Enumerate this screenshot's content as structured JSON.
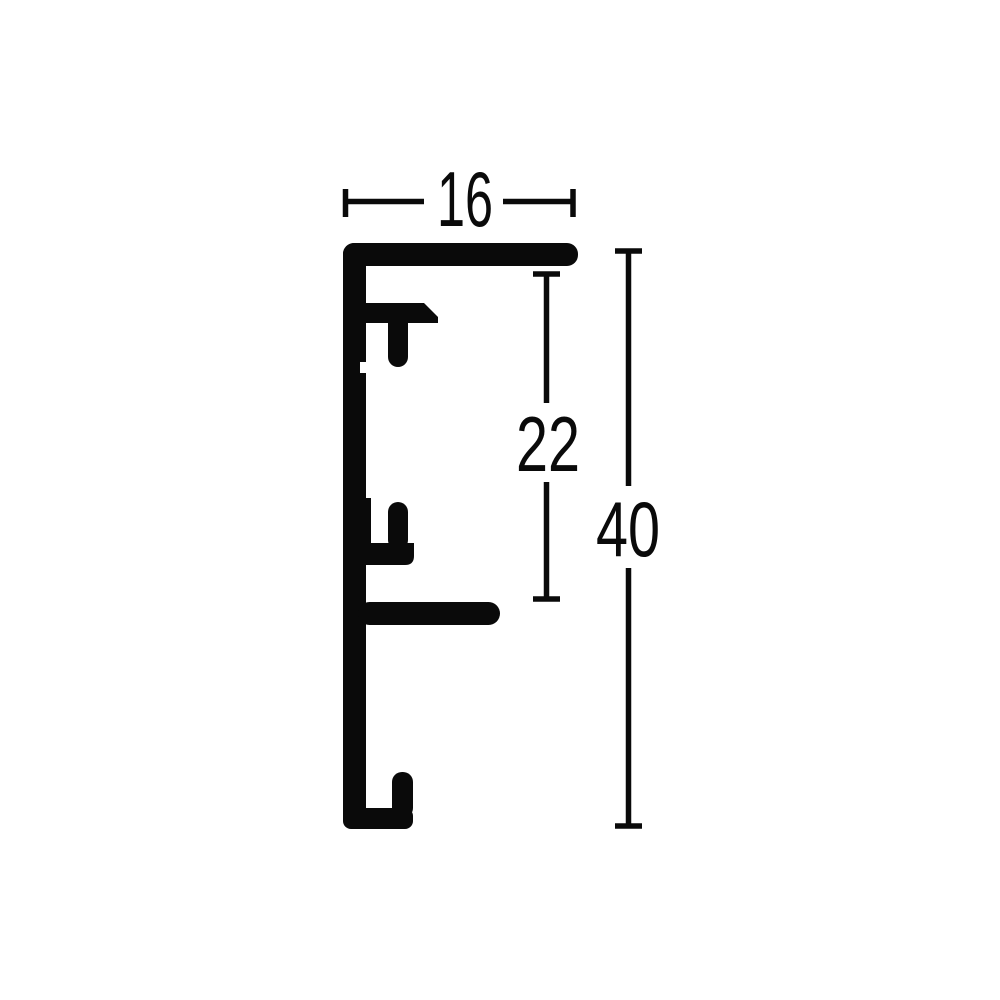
{
  "diagram": {
    "description": "technical cross-section drawing of an aluminium frame profile with three dimension callouts",
    "background_color": "#ffffff",
    "line_color": "#0a0a0a",
    "dimensions": {
      "width": {
        "label": "16",
        "orientation": "horizontal",
        "position": "top"
      },
      "middle_height": {
        "label": "22",
        "orientation": "vertical",
        "position": "inner-right"
      },
      "total_height": {
        "label": "40",
        "orientation": "vertical",
        "position": "outer-right"
      }
    }
  }
}
